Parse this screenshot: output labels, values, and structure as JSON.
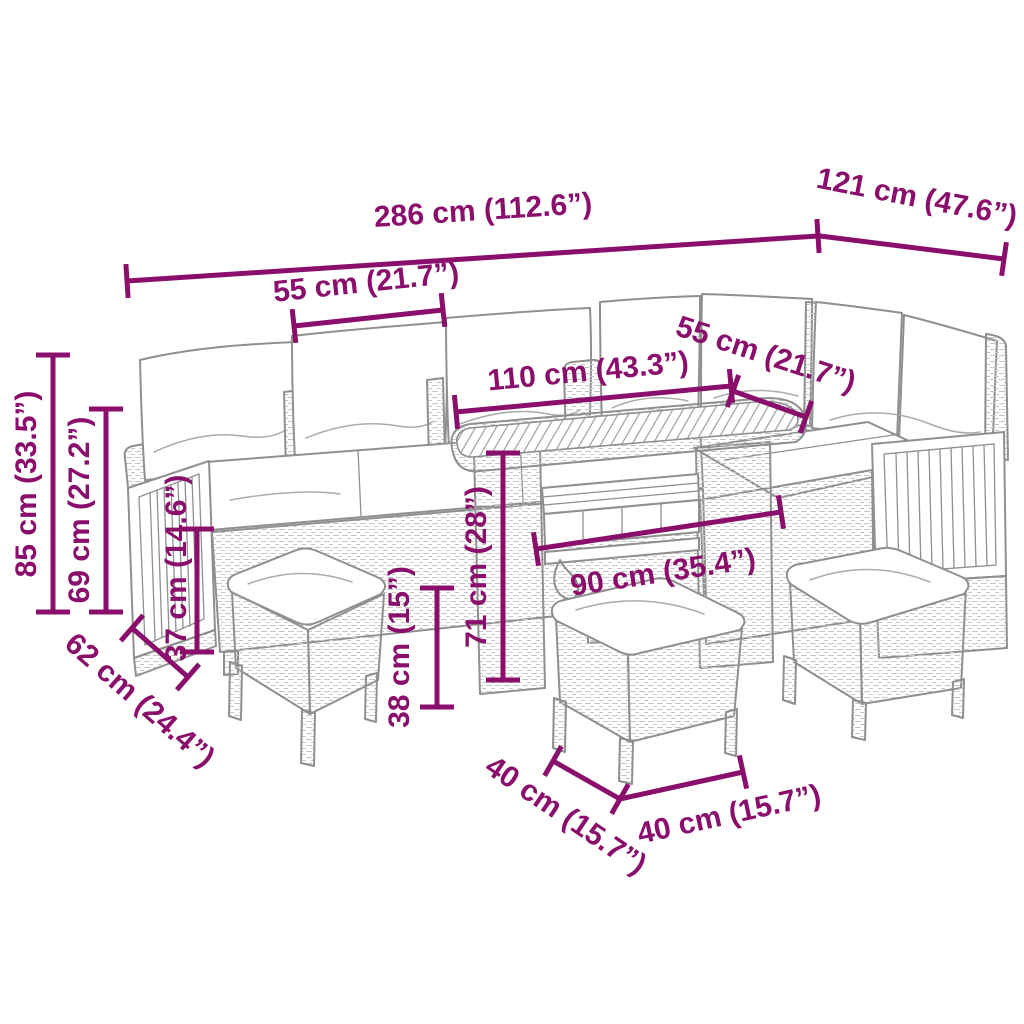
{
  "diagram": {
    "subject": "rattan garden lounge set with corner sofa, cushions, slatted table and three stools",
    "accent_color": "#8a0e6b",
    "sketch_color": "#8f8f8f",
    "background_color": "#ffffff",
    "unit_primary": "cm",
    "unit_secondary": "in",
    "dimensions": [
      {
        "id": "total-width",
        "label": "286 cm (112.6”)",
        "cm": 286,
        "inches": 112.6
      },
      {
        "id": "total-depth",
        "label": "121 cm (47.6”)",
        "cm": 121,
        "inches": 47.6
      },
      {
        "id": "left-seat-width",
        "label": "55 cm (21.7”)",
        "cm": 55,
        "inches": 21.7
      },
      {
        "id": "table-top-length",
        "label": "110 cm (43.3”)",
        "cm": 110,
        "inches": 43.3
      },
      {
        "id": "right-seat-width",
        "label": "55 cm (21.7”)",
        "cm": 55,
        "inches": 21.7
      },
      {
        "id": "back-height",
        "label": "85 cm (33.5”)",
        "cm": 85,
        "inches": 33.5
      },
      {
        "id": "arm-height",
        "label": "69 cm (27.2”)",
        "cm": 69,
        "inches": 27.2
      },
      {
        "id": "seat-height",
        "label": "37 cm (14.6”)",
        "cm": 37,
        "inches": 14.6
      },
      {
        "id": "seat-depth",
        "label": "62 cm (24.4”)",
        "cm": 62,
        "inches": 24.4
      },
      {
        "id": "stool-height",
        "label": "38 cm (15”)",
        "cm": 38,
        "inches": 15
      },
      {
        "id": "table-height",
        "label": "71 cm (28”)",
        "cm": 71,
        "inches": 28
      },
      {
        "id": "table-base-width",
        "label": "90 cm (35.4”)",
        "cm": 90,
        "inches": 35.4
      },
      {
        "id": "stool-depth",
        "label": "40 cm (15.7”)",
        "cm": 40,
        "inches": 15.7
      },
      {
        "id": "stool-width",
        "label": "40 cm (15.7”)",
        "cm": 40,
        "inches": 15.7
      }
    ]
  }
}
